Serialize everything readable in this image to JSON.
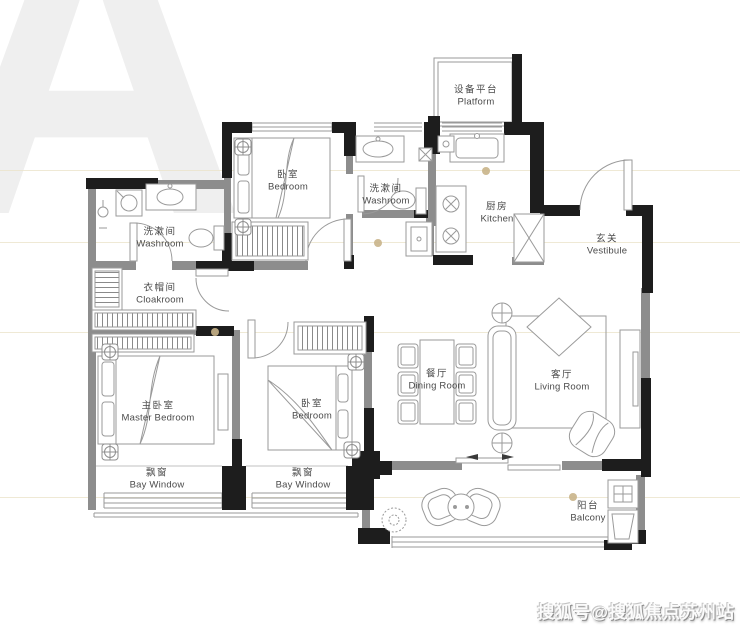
{
  "watermark": {
    "letter": "A",
    "credit": "搜狐号@搜狐焦点苏州站"
  },
  "palette": {
    "wall_black": "#1d1d1d",
    "wall_gray": "#8d8d8d",
    "furniture_line": "#9a9a9a",
    "label_text": "#4b4b4b",
    "guide_line": "#ece4cb",
    "accent_dot": "#c9b489"
  },
  "rooms": [
    {
      "id": "platform",
      "cn": "设备平台",
      "en": "Platform"
    },
    {
      "id": "bedroom-top",
      "cn": "卧室",
      "en": "Bedroom"
    },
    {
      "id": "washroom-mid",
      "cn": "洗漱间",
      "en": "Washroom"
    },
    {
      "id": "washroom-left",
      "cn": "洗漱间",
      "en": "Washroom"
    },
    {
      "id": "kitchen",
      "cn": "厨房",
      "en": "Kitchen"
    },
    {
      "id": "vestibule",
      "cn": "玄关",
      "en": "Vestibule"
    },
    {
      "id": "cloakroom",
      "cn": "衣帽间",
      "en": "Cloakroom"
    },
    {
      "id": "master-bedroom",
      "cn": "主卧室",
      "en": "Master Bedroom"
    },
    {
      "id": "bedroom-second",
      "cn": "卧室",
      "en": "Bedroom"
    },
    {
      "id": "dining-room",
      "cn": "餐厅",
      "en": "Dining Room"
    },
    {
      "id": "living-room",
      "cn": "客厅",
      "en": "Living Room"
    },
    {
      "id": "bay-window-left",
      "cn": "飘窗",
      "en": "Bay Window"
    },
    {
      "id": "bay-window-right",
      "cn": "飘窗",
      "en": "Bay Window"
    },
    {
      "id": "balcony",
      "cn": "阳台",
      "en": "Balcony"
    }
  ]
}
